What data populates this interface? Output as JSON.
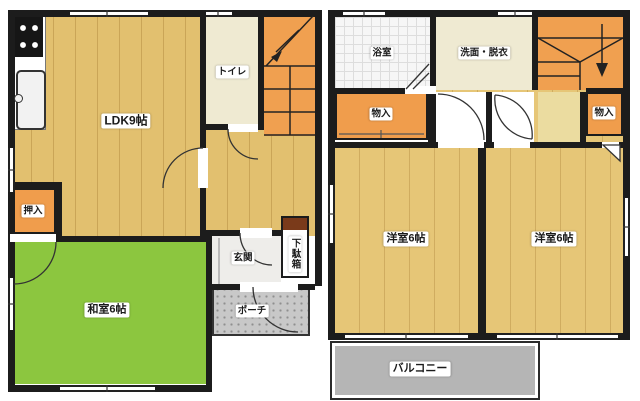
{
  "floor1": {
    "ldk": "LDK9帖",
    "toilet": "トイレ",
    "closet": "押入",
    "tatami_room": "和室6帖",
    "entrance": "玄関",
    "shoe_cabinet": "下駄箱",
    "porch": "ポーチ"
  },
  "floor2": {
    "bathroom": "浴室",
    "washroom": "洗面・脱衣",
    "storage_left": "物入",
    "storage_right": "物入",
    "bedroom_left": "洋室6帖",
    "bedroom_right": "洋室6帖",
    "balcony": "バルコニー"
  },
  "colors": {
    "wall": "#1c1c1c",
    "wood_floor": "#e2c06f",
    "tatami_green": "#8cc63f",
    "closet_orange": "#f09d4c",
    "cream": "#efead2",
    "tile_white": "#f6f6f6",
    "porch_gray": "#c8c8c8",
    "balcony_gray": "#b5b5b5",
    "shoe_cabinet_top": "#7a3a1a"
  }
}
